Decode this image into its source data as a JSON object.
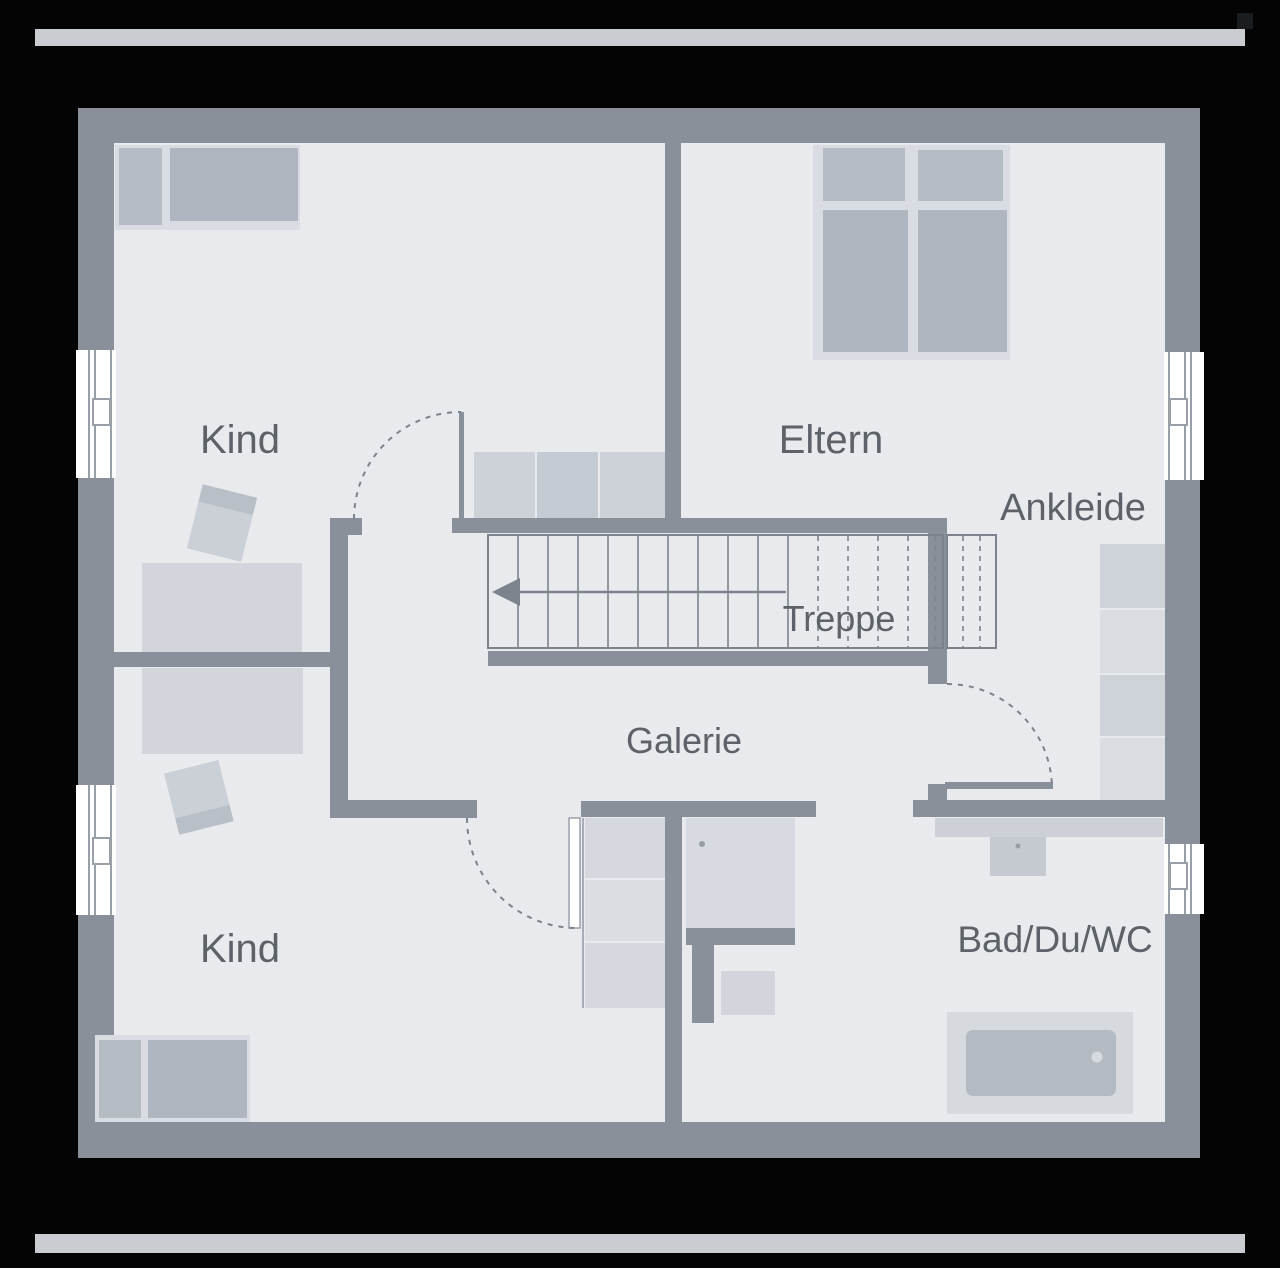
{
  "title": "Obergeschoss Grundriss",
  "rooms": {
    "kind_top": {
      "label": "Kind"
    },
    "eltern": {
      "label": "Eltern"
    },
    "ankleide": {
      "label": "Ankleide"
    },
    "treppe": {
      "label": "Treppe"
    },
    "galerie": {
      "label": "Galerie"
    },
    "kind_bottom": {
      "label": "Kind"
    },
    "bad": {
      "label": "Bad/Du/WC"
    }
  },
  "colors": {
    "bg": "#040404",
    "bar": "#c9ccd0",
    "wall": "#8a9099",
    "floor": "#e8eaed",
    "line": "#7d838c",
    "text": "#5d6269",
    "window_white": "#ffffff",
    "window_frame": "#9aa0a8",
    "furn_light": "#cbd0d6",
    "furn_med": "#b9bfc7",
    "mattress": "#b0b6bf",
    "pillow": "#b6bcc4",
    "bed_base": "#d9dce2",
    "ward_dark": "#ced3d9",
    "ward_light": "#d9dce1",
    "closet_light": "#d5d8de",
    "closet_lighter": "#dadde2",
    "tub_inner": "#b4bac2",
    "knob": "#979da6",
    "notch": "#1a1d20",
    "sideboard_a": "#cdd2d8",
    "sideboard_b": "#c5cbd2",
    "bed_flat": "#d2d6dc",
    "dresser": "#d7dae0",
    "counter": "#cdd1d7",
    "sink": "#c5cad1",
    "tub_outer": "#d6d9de",
    "closet_edge": "#a7adb5"
  }
}
